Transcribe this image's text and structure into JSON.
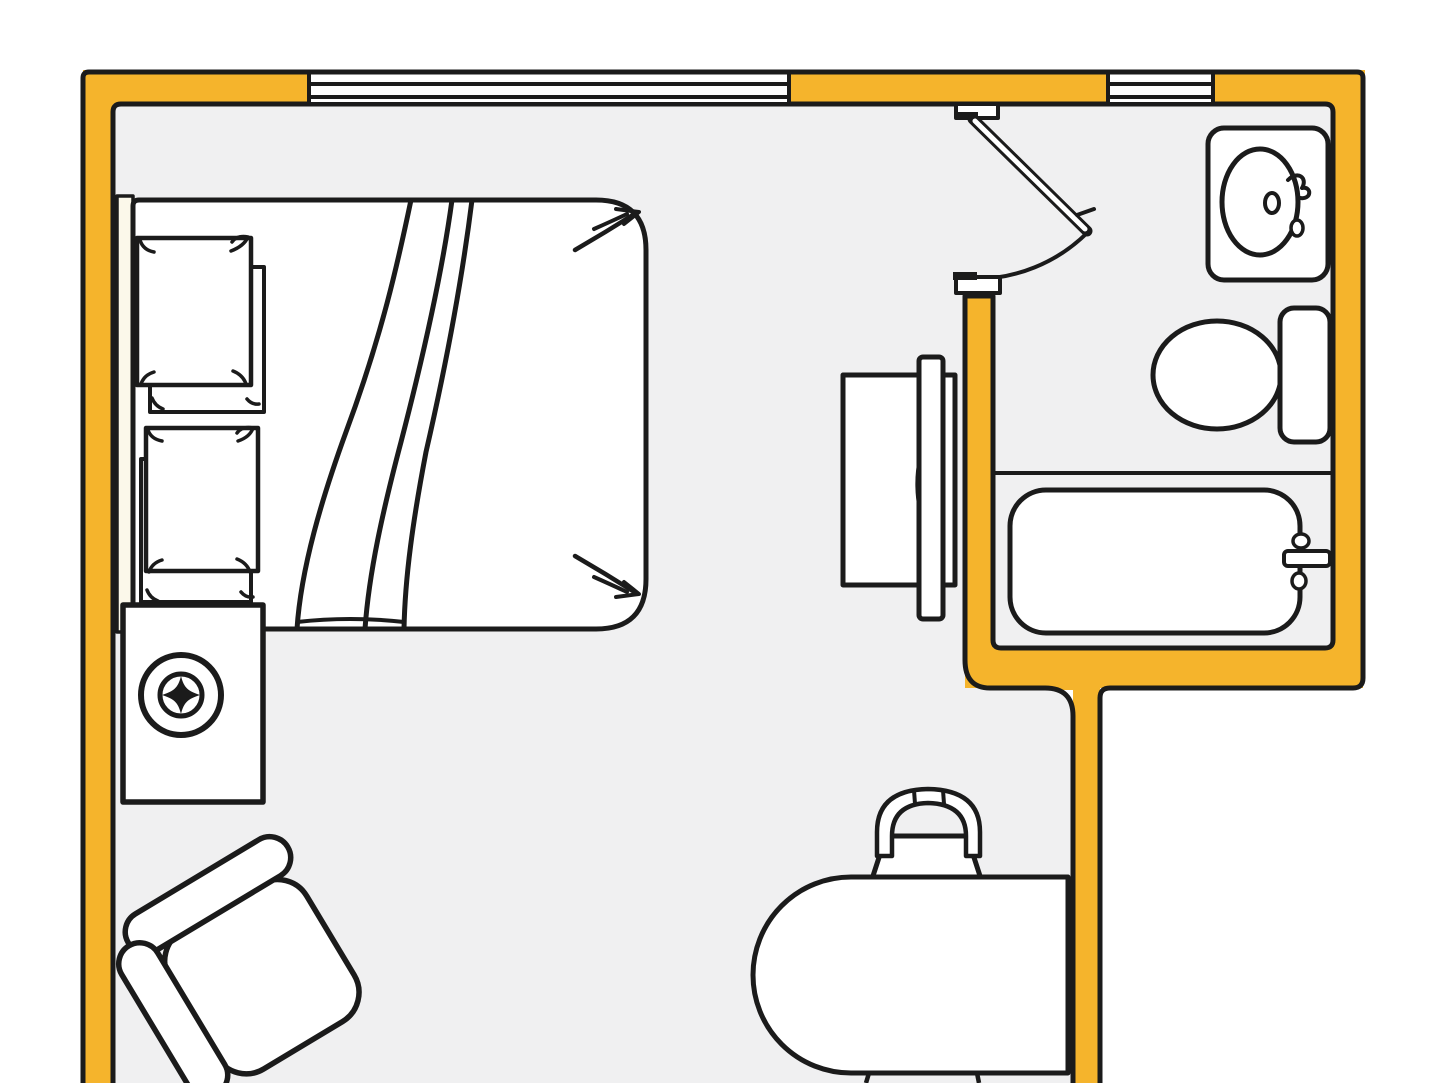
{
  "meta": {
    "description": "Hand-drawn style studio apartment floor plan with bedroom area and bathroom",
    "canvas": {
      "width": 1440,
      "height": 1083
    }
  },
  "colors": {
    "ink": "#1b1b1b",
    "wall": "#F5B42C",
    "floor": "#F0F0F1",
    "white": "#FFFFFF",
    "cream": "#FBF8EA",
    "outside": "#FFFFFF",
    "none": "none"
  },
  "rooms": [
    {
      "name": "main-room",
      "contents": [
        "double-bed",
        "speaker-cabinet",
        "armchair",
        "tv-console",
        "desk",
        "desk-chair"
      ]
    },
    {
      "name": "bathroom",
      "contents": [
        "sink",
        "toilet",
        "bathtub"
      ]
    }
  ],
  "scene": {
    "shapes": [
      {
        "n": "background",
        "k": "rect",
        "x": 0,
        "y": 0,
        "w": 1440,
        "h": 1083,
        "f": "outside"
      },
      {
        "n": "floor",
        "k": "path",
        "d": "M113,1083 L113,112 Q113,104 121,104 L1325,104 Q1333,104 1333,112 L1333,640 Q1333,648 1325,648 L1001,648 Q993,648 993,640 L993,296 L965,296 L965,660 Q965,688 990,688 L1045,688 Q1073,688 1073,716 L1073,1083 Z",
        "f": "floor"
      },
      {
        "n": "wall-left",
        "k": "rect",
        "x": 83,
        "y": 70,
        "w": 30,
        "h": 1013,
        "f": "wall"
      },
      {
        "n": "wall-top-a",
        "k": "rect",
        "x": 83,
        "y": 70,
        "w": 226,
        "h": 34,
        "f": "wall"
      },
      {
        "n": "wall-top-b",
        "k": "rect",
        "x": 789,
        "y": 70,
        "w": 319,
        "h": 34,
        "f": "wall"
      },
      {
        "n": "wall-top-c",
        "k": "rect",
        "x": 1213,
        "y": 70,
        "w": 152,
        "h": 34,
        "f": "wall"
      },
      {
        "n": "wall-right",
        "k": "rect",
        "x": 1331,
        "y": 70,
        "w": 32,
        "h": 618,
        "f": "wall"
      },
      {
        "n": "wall-bath-bottom",
        "k": "rect",
        "x": 965,
        "y": 648,
        "w": 398,
        "h": 40,
        "f": "wall"
      },
      {
        "n": "wall-divider",
        "k": "rect",
        "x": 965,
        "y": 292,
        "w": 28,
        "h": 360,
        "f": "wall"
      },
      {
        "n": "wall-corridor",
        "k": "rect",
        "x": 1073,
        "y": 652,
        "w": 27,
        "h": 431,
        "f": "wall"
      },
      {
        "n": "wall-junction",
        "k": "path",
        "d": "M965,648 L1100,648 L1100,690 L990,690 Q965,690 965,664 Z",
        "f": "wall"
      },
      {
        "n": "door-jamb-tab",
        "k": "rect",
        "x": 962,
        "y": 96,
        "w": 30,
        "h": 10,
        "f": "wall"
      },
      {
        "n": "wall-outline-outer",
        "k": "path",
        "d": "M83,1083 L83,78 Q83,72 89,72 L1357,72 Q1363,72 1363,78 L1363,678 Q1363,688 1353,688 L1110,688 Q1100,688 1100,698 L1100,1083",
        "f": "none",
        "s": "ink",
        "sw": 5
      },
      {
        "n": "wall-outline-inner",
        "k": "path",
        "d": "M113,1083 L113,112 Q113,104 121,104 L1325,104 Q1333,104 1333,112 L1333,640 Q1333,648 1325,648 L1001,648 Q993,648 993,640 L993,296 L965,296 L965,660 Q965,688 990,688 L1045,688 Q1073,688 1073,716 L1073,1083",
        "f": "none",
        "s": "ink",
        "sw": 5
      },
      {
        "n": "window-1-glass",
        "k": "rect",
        "x": 309,
        "y": 75,
        "w": 480,
        "h": 27,
        "f": "white"
      },
      {
        "n": "window-2-glass",
        "k": "rect",
        "x": 1108,
        "y": 75,
        "w": 105,
        "h": 27,
        "f": "white"
      },
      {
        "n": "window-1-sash",
        "k": "rect",
        "x": 309,
        "y": 84,
        "w": 480,
        "h": 13,
        "f": "white",
        "s": "ink",
        "sw": 4
      },
      {
        "n": "window-2-sash",
        "k": "rect",
        "x": 1108,
        "y": 84,
        "w": 105,
        "h": 13,
        "f": "white",
        "s": "ink",
        "sw": 4
      },
      {
        "n": "window-1-left-tick",
        "k": "line",
        "x1": 309,
        "y1": 72,
        "x2": 309,
        "y2": 104,
        "s": "ink",
        "sw": 4
      },
      {
        "n": "window-1-right-tick",
        "k": "line",
        "x1": 789,
        "y1": 72,
        "x2": 789,
        "y2": 104,
        "s": "ink",
        "sw": 4
      },
      {
        "n": "window-2-left-tick",
        "k": "line",
        "x1": 1108,
        "y1": 72,
        "x2": 1108,
        "y2": 104,
        "s": "ink",
        "sw": 4
      },
      {
        "n": "window-2-right-tick",
        "k": "line",
        "x1": 1213,
        "y1": 72,
        "x2": 1213,
        "y2": 104,
        "s": "ink",
        "sw": 4
      },
      {
        "n": "door-top-jamb-cap",
        "k": "rect",
        "x": 956,
        "y": 104,
        "w": 42,
        "h": 14,
        "f": "white",
        "s": "ink",
        "sw": 4
      },
      {
        "n": "door-hinge-plate",
        "k": "rect",
        "x": 958,
        "y": 112,
        "w": 20,
        "h": 7,
        "f": "ink"
      },
      {
        "n": "door-leaf-outline",
        "k": "line",
        "x1": 973,
        "y1": 119,
        "x2": 1087,
        "y2": 231,
        "s": "ink",
        "sw": 11,
        "lc": "round"
      },
      {
        "n": "door-leaf-face",
        "k": "line",
        "x1": 975,
        "y1": 121,
        "x2": 1085,
        "y2": 229,
        "s": "white",
        "sw": 5,
        "lc": "round"
      },
      {
        "n": "door-handle",
        "k": "path",
        "d": "M1077,215 l17,-6",
        "f": "none",
        "s": "ink",
        "sw": 4,
        "lc": "round"
      },
      {
        "n": "door-swing-arc",
        "k": "path",
        "d": "M1087,233 A160,160 0 0 1 973,279",
        "f": "none",
        "s": "ink",
        "sw": 4
      },
      {
        "n": "door-bottom-jamb-cap",
        "k": "rect",
        "x": 956,
        "y": 277,
        "w": 44,
        "h": 16,
        "f": "white",
        "s": "ink",
        "sw": 4
      },
      {
        "n": "door-strike-plate",
        "k": "rect",
        "x": 953,
        "y": 272,
        "w": 24,
        "h": 8,
        "f": "ink"
      },
      {
        "n": "tub-alcove-line",
        "k": "line",
        "x1": 995,
        "y1": 473,
        "x2": 1331,
        "y2": 473,
        "s": "ink",
        "sw": 4
      },
      {
        "n": "sink-counter",
        "k": "rect",
        "x": 1208,
        "y": 128,
        "w": 120,
        "h": 152,
        "rx": 16,
        "f": "white",
        "s": "ink",
        "sw": 5
      },
      {
        "n": "sink-basin",
        "k": "ellipse",
        "cx": 1260,
        "cy": 202,
        "rx": 38,
        "ry": 53,
        "f": "white",
        "s": "ink",
        "sw": 5
      },
      {
        "n": "sink-drain",
        "k": "ellipse",
        "cx": 1272,
        "cy": 203,
        "rx": 7,
        "ry": 10,
        "f": "white",
        "s": "ink",
        "sw": 4
      },
      {
        "n": "sink-faucet",
        "k": "path",
        "d": "M1288,180 c10,-10 20,-2 14,8 c10,-2 10,12 -2,10",
        "f": "none",
        "s": "ink",
        "sw": 4,
        "lc": "round"
      },
      {
        "n": "sink-faucet-knob",
        "k": "ellipse",
        "cx": 1297,
        "cy": 228,
        "rx": 6,
        "ry": 8,
        "f": "white",
        "s": "ink",
        "sw": 3.5
      },
      {
        "n": "toilet-bowl",
        "k": "ellipse",
        "cx": 1217,
        "cy": 375,
        "rx": 64,
        "ry": 54,
        "f": "white",
        "s": "ink",
        "sw": 5
      },
      {
        "n": "toilet-tank",
        "k": "rect",
        "x": 1280,
        "y": 308,
        "w": 50,
        "h": 134,
        "rx": 14,
        "f": "white",
        "s": "ink",
        "sw": 5
      },
      {
        "n": "bathtub",
        "k": "rect",
        "x": 1010,
        "y": 490,
        "w": 290,
        "h": 143,
        "rx": 36,
        "f": "white",
        "s": "ink",
        "sw": 5
      },
      {
        "n": "tub-faucet-bar",
        "k": "rect",
        "x": 1284,
        "y": 551,
        "w": 46,
        "h": 15,
        "rx": 4,
        "f": "white",
        "s": "ink",
        "sw": 4
      },
      {
        "n": "tub-faucet-knob-top",
        "k": "ellipse",
        "cx": 1301,
        "cy": 541,
        "rx": 8,
        "ry": 7,
        "f": "white",
        "s": "ink",
        "sw": 3.5
      },
      {
        "n": "tub-faucet-knob-bottom",
        "k": "ellipse",
        "cx": 1299,
        "cy": 581,
        "rx": 7,
        "ry": 8,
        "f": "white",
        "s": "ink",
        "sw": 3.5
      },
      {
        "n": "bed-headboard",
        "k": "rect",
        "x": 117,
        "y": 196,
        "w": 16,
        "h": 436,
        "f": "cream",
        "s": "ink",
        "sw": 3.5
      },
      {
        "n": "bed-mattress",
        "k": "path",
        "d": "M139,629 Q133,629 133,623 L133,206 Q133,200 139,200 L596,200 Q646,200 646,250 L646,579 Q646,629 596,629 Z",
        "f": "white",
        "s": "ink",
        "sw": 5
      },
      {
        "n": "blanket-fold-1",
        "k": "path",
        "d": "M411,200 C398,262 382,335 346,432 C322,498 301,568 297,629",
        "f": "none",
        "s": "ink",
        "sw": 5
      },
      {
        "n": "blanket-fold-2",
        "k": "path",
        "d": "M452,200 C443,266 427,342 401,442 C383,510 369,572 365,629",
        "f": "none",
        "s": "ink",
        "sw": 5
      },
      {
        "n": "blanket-fold-3",
        "k": "path",
        "d": "M472,200 C463,272 449,352 426,452 C413,520 405,577 404,629",
        "f": "none",
        "s": "ink",
        "sw": 5
      },
      {
        "n": "blanket-hem",
        "k": "path",
        "d": "M297,622 Q350,616 404,622",
        "f": "none",
        "s": "ink",
        "sw": 4
      },
      {
        "n": "pillow-1-under",
        "k": "rect",
        "x": 150,
        "y": 267,
        "w": 114,
        "h": 145,
        "f": "white",
        "s": "ink",
        "sw": 4
      },
      {
        "n": "pillow-1",
        "k": "rect",
        "x": 137,
        "y": 238,
        "w": 114,
        "h": 147,
        "f": "white",
        "s": "ink",
        "sw": 4.5
      },
      {
        "n": "pillow-1-curl-tl",
        "k": "path",
        "d": "M154,252 Q143,250 140,240",
        "f": "none",
        "s": "ink",
        "sw": 3.5,
        "lc": "round"
      },
      {
        "n": "pillow-1-curl-tr",
        "k": "path",
        "d": "M231,251 Q244,246 248,237 Q237,235 232,242",
        "f": "none",
        "s": "ink",
        "sw": 3.5,
        "lc": "round"
      },
      {
        "n": "pillow-1-curl-bl",
        "k": "path",
        "d": "M154,372 Q144,375 141,384",
        "f": "none",
        "s": "ink",
        "sw": 3.5,
        "lc": "round"
      },
      {
        "n": "pillow-1-curl-br",
        "k": "path",
        "d": "M233,371 Q243,375 246,384",
        "f": "none",
        "s": "ink",
        "sw": 3.5,
        "lc": "round"
      },
      {
        "n": "pillow-1-under-curl-l",
        "k": "path",
        "d": "M152,398 Q155,406 163,409",
        "f": "none",
        "s": "ink",
        "sw": 3.5,
        "lc": "round"
      },
      {
        "n": "pillow-1-under-curl-r",
        "k": "path",
        "d": "M247,399 Q252,405 259,404",
        "f": "none",
        "s": "ink",
        "sw": 3.5,
        "lc": "round"
      },
      {
        "n": "pillow-2-under",
        "k": "rect",
        "x": 141,
        "y": 459,
        "w": 110,
        "h": 143,
        "f": "white",
        "s": "ink",
        "sw": 4
      },
      {
        "n": "pillow-2",
        "k": "rect",
        "x": 146,
        "y": 428,
        "w": 112,
        "h": 143,
        "f": "white",
        "s": "ink",
        "sw": 4.5
      },
      {
        "n": "pillow-2-curl-tl",
        "k": "path",
        "d": "M162,441 Q151,439 148,430",
        "f": "none",
        "s": "ink",
        "sw": 3.5,
        "lc": "round"
      },
      {
        "n": "pillow-2-curl-tr",
        "k": "path",
        "d": "M238,441 Q250,437 253,428 Q242,426 237,433",
        "f": "none",
        "s": "ink",
        "sw": 3.5,
        "lc": "round"
      },
      {
        "n": "pillow-2-curl-bl",
        "k": "path",
        "d": "M162,560 Q152,563 149,572",
        "f": "none",
        "s": "ink",
        "sw": 3.5,
        "lc": "round"
      },
      {
        "n": "pillow-2-curl-br",
        "k": "path",
        "d": "M237,559 Q247,563 250,572",
        "f": "none",
        "s": "ink",
        "sw": 3.5,
        "lc": "round"
      },
      {
        "n": "pillow-2-under-curl-l",
        "k": "path",
        "d": "M147,590 Q150,598 158,601",
        "f": "none",
        "s": "ink",
        "sw": 3.5,
        "lc": "round"
      },
      {
        "n": "pillow-2-under-curl-r",
        "k": "path",
        "d": "M241,592 Q246,598 253,597",
        "f": "none",
        "s": "ink",
        "sw": 3.5,
        "lc": "round"
      },
      {
        "n": "mattress-corner-arrow-tr-1",
        "k": "path",
        "d": "M575,250 Q606,232 636,213",
        "f": "none",
        "s": "ink",
        "sw": 4.5,
        "lc": "round"
      },
      {
        "n": "mattress-corner-arrow-tr-2",
        "k": "path",
        "d": "M594,229 Q612,221 627,214",
        "f": "none",
        "s": "ink",
        "sw": 4,
        "lc": "round"
      },
      {
        "n": "mattress-corner-arrow-tr-head",
        "k": "path",
        "d": "M616,209 L639,212 L624,224",
        "f": "none",
        "s": "ink",
        "sw": 4,
        "lc": "round"
      },
      {
        "n": "mattress-corner-arrow-br-1",
        "k": "path",
        "d": "M575,556 Q606,574 636,593",
        "f": "none",
        "s": "ink",
        "sw": 4.5,
        "lc": "round"
      },
      {
        "n": "mattress-corner-arrow-br-2",
        "k": "path",
        "d": "M594,577 Q612,585 627,592",
        "f": "none",
        "s": "ink",
        "sw": 4,
        "lc": "round"
      },
      {
        "n": "mattress-corner-arrow-br-head",
        "k": "path",
        "d": "M616,597 L639,594 L624,582",
        "f": "none",
        "s": "ink",
        "sw": 4,
        "lc": "round"
      },
      {
        "n": "tv-console",
        "k": "rect",
        "x": 843,
        "y": 375,
        "w": 112,
        "h": 210,
        "f": "white",
        "s": "ink",
        "sw": 5
      },
      {
        "n": "tv-lens",
        "k": "path",
        "d": "M930,437 C946,456 949,514 931,536 C914,515 912,458 930,437 Z",
        "f": "white",
        "s": "ink",
        "sw": 4
      },
      {
        "n": "tv-screen-bar",
        "k": "rect",
        "x": 919,
        "y": 357,
        "w": 24,
        "h": 262,
        "rx": 4,
        "f": "white",
        "s": "ink",
        "sw": 5
      },
      {
        "n": "speaker-cabinet",
        "k": "rect",
        "x": 123,
        "y": 605,
        "w": 140,
        "h": 197,
        "f": "white",
        "s": "ink",
        "sw": 5.5
      },
      {
        "n": "speaker-ring-outer",
        "k": "circle",
        "cx": 181,
        "cy": 695,
        "r": 40,
        "f": "white",
        "s": "ink",
        "sw": 6
      },
      {
        "n": "speaker-ring-inner",
        "k": "circle",
        "cx": 181,
        "cy": 695,
        "r": 21,
        "f": "white",
        "s": "ink",
        "sw": 5
      },
      {
        "n": "speaker-star",
        "k": "path",
        "d": "M181,676 C184,688 188,691 200,695 C188,699 184,702 181,714 C178,702 174,699 162,695 C174,691 178,688 181,676 Z",
        "f": "ink"
      },
      {
        "n": "armchair-seat",
        "k": "rect",
        "x": -75,
        "y": -75,
        "w": 160,
        "h": 160,
        "rx": 34,
        "f": "white",
        "s": "ink",
        "sw": 5.5,
        "t": "translate(255,975) rotate(-31)"
      },
      {
        "n": "armchair-back",
        "k": "rect",
        "x": -92,
        "y": -114,
        "w": 186,
        "h": 42,
        "rx": 21,
        "f": "white",
        "s": "ink",
        "sw": 5.5,
        "t": "translate(255,975) rotate(-31)"
      },
      {
        "n": "armchair-armrest",
        "k": "rect",
        "x": -114,
        "y": -90,
        "w": 42,
        "h": 172,
        "rx": 21,
        "f": "white",
        "s": "ink",
        "sw": 5.5,
        "t": "translate(255,975) rotate(-31)"
      },
      {
        "n": "desk-chair-seat",
        "k": "path",
        "d": "M886,836 L967,836 L981,879 L872,879 Z",
        "f": "white",
        "s": "ink",
        "sw": 5
      },
      {
        "n": "desk-chair-back",
        "k": "path",
        "d": "M877,856 L877,832 Q877,790 928,789 Q980,790 980,832 L980,856 L966,856 L966,836 Q966,804 928,803 Q892,804 892,836 L892,856 Z",
        "f": "white",
        "s": "ink",
        "sw": 4.5
      },
      {
        "n": "desk-chair-back-spoke-1",
        "k": "line",
        "x1": 914,
        "y1": 790,
        "x2": 915,
        "y2": 804,
        "s": "ink",
        "sw": 4
      },
      {
        "n": "desk-chair-back-spoke-2",
        "k": "line",
        "x1": 943,
        "y1": 790,
        "x2": 944,
        "y2": 804,
        "s": "ink",
        "sw": 4
      },
      {
        "n": "desk",
        "k": "path",
        "d": "M1068,877 L851,877 A98,98 0 0 0 851,1073 L1068,1073 Z",
        "f": "white",
        "s": "ink",
        "sw": 5
      },
      {
        "n": "second-chair-leg-1",
        "k": "line",
        "x1": 869,
        "y1": 1073,
        "x2": 866,
        "y2": 1083,
        "s": "ink",
        "sw": 4.5
      },
      {
        "n": "second-chair-leg-2",
        "k": "line",
        "x1": 977,
        "y1": 1073,
        "x2": 979,
        "y2": 1083,
        "s": "ink",
        "sw": 4.5
      }
    ]
  }
}
